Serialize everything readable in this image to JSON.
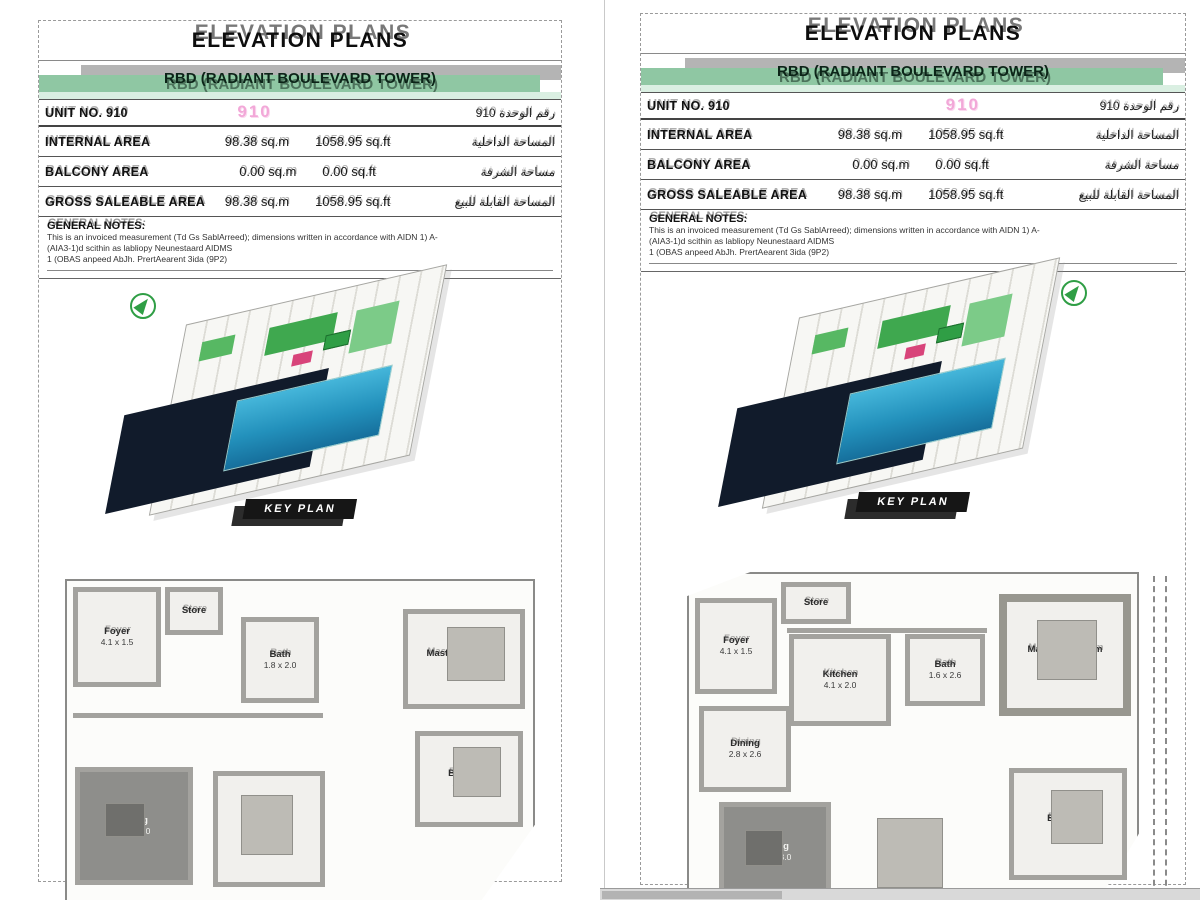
{
  "colors": {
    "band_green": "#8fc7a3",
    "band_gray": "#b4b4b4",
    "band_pale_green": "#daefe2",
    "unit_stamp_pink": "#f2a8d8",
    "keyplan_pool_blue": "#2391bc",
    "keyplan_shadow_navy": "#111b2b",
    "keyplan_green": "#3fa84f",
    "keyplan_red": "#d8447a",
    "wall_gray": "#a3a29e"
  },
  "panels": [
    {
      "title": "ELEVATION PLANS",
      "subtitle": "RBD (RADIANT BOULEVARD TOWER)",
      "unit_stamp": "910",
      "table": {
        "rows": [
          {
            "label": "UNIT NO. 910",
            "sqm": "",
            "sqft": "",
            "arabic": "رقم الوحدة 910"
          },
          {
            "label": "INTERNAL AREA",
            "sqm": "98.38 sq.m",
            "sqft": "1058.95 sq.ft",
            "arabic": "المساحة الداخلية"
          },
          {
            "label": "BALCONY AREA",
            "sqm": "0.00 sq.m",
            "sqft": "0.00 sq.ft",
            "arabic": "مساحة الشرفة"
          },
          {
            "label": "GROSS SALEABLE AREA",
            "sqm": "98.38 sq.m",
            "sqft": "1058.95 sq.ft",
            "arabic": "المساحة القابلة للبيع"
          }
        ]
      },
      "notes": {
        "heading": "GENERAL NOTES:",
        "lines": [
          "This is an invoiced measurement (Td Gs SablArreed); dimensions written in accordance with AIDN 1) A-",
          "(AIA3-1)d scithin as labliopy Neunestaard AIDMS",
          "1 (OBAS anpeed AbJh. PrertAearent 3ida (9P2)"
        ]
      },
      "keyplan_label": "KEY PLAN",
      "floorplan_label": "FLOOR PLAN",
      "floorplan": {
        "rooms": [
          {
            "name": "Foyer",
            "dims": "4.1 x 1.5"
          },
          {
            "name": "Store",
            "dims": ""
          },
          {
            "name": "Bath",
            "dims": "1.8 x 2.0"
          },
          {
            "name": "Master Bedroom",
            "dims": "4.0 x 3.8"
          },
          {
            "name": "Bedroom",
            "dims": "3.0 x 3.1"
          },
          {
            "name": "Living",
            "dims": "2.3 x 3.0"
          },
          {
            "name": "Bedroom",
            "dims": "4.3 x 3.2"
          }
        ]
      }
    },
    {
      "title": "ELEVATION PLANS",
      "subtitle": "RBD (RADIANT BOULEVARD TOWER)",
      "unit_stamp": "910",
      "table": {
        "rows": [
          {
            "label": "UNIT NO. 910",
            "sqm": "",
            "sqft": "",
            "arabic": "رقم الوحدة 910"
          },
          {
            "label": "INTERNAL AREA",
            "sqm": "98.38 sq.m",
            "sqft": "1058.95 sq.ft",
            "arabic": "المساحة الداخلية"
          },
          {
            "label": "BALCONY AREA",
            "sqm": "0.00 sq.m",
            "sqft": "0.00 sq.ft",
            "arabic": "مساحة الشرفة"
          },
          {
            "label": "GROSS SALEABLE AREA",
            "sqm": "98.38 sq.m",
            "sqft": "1058.95 sq.ft",
            "arabic": "المساحة القابلة للبيع"
          }
        ]
      },
      "notes": {
        "heading": "GENERAL NOTES:",
        "lines": [
          "This is an invoiced measurement (Td Gs SablArreed); dimensions written in accordance with AIDN 1) A-",
          "(AIA3-1)d scithin as labliopy Neunestaard AIDMS",
          "1 (OBAS anpeed AbJh. PrertAearent 3ida (9P2)"
        ]
      },
      "keyplan_label": "KEY PLAN",
      "floorplan_label": "FLOOR PLAN",
      "floorplan": {
        "rooms": [
          {
            "name": "Foyer",
            "dims": "4.1 x 1.5"
          },
          {
            "name": "Store",
            "dims": ""
          },
          {
            "name": "Kitchen",
            "dims": "4.1 x 2.0"
          },
          {
            "name": "Bath",
            "dims": "1.6 x 2.6"
          },
          {
            "name": "Dining",
            "dims": "2.8 x 2.6"
          },
          {
            "name": "Living",
            "dims": "2.3 x 3.0"
          },
          {
            "name": "Bedroom",
            "dims": "4.3 x 3.2"
          },
          {
            "name": "Master Bedroom",
            "dims": "4.0 x 3.8"
          }
        ]
      }
    }
  ]
}
